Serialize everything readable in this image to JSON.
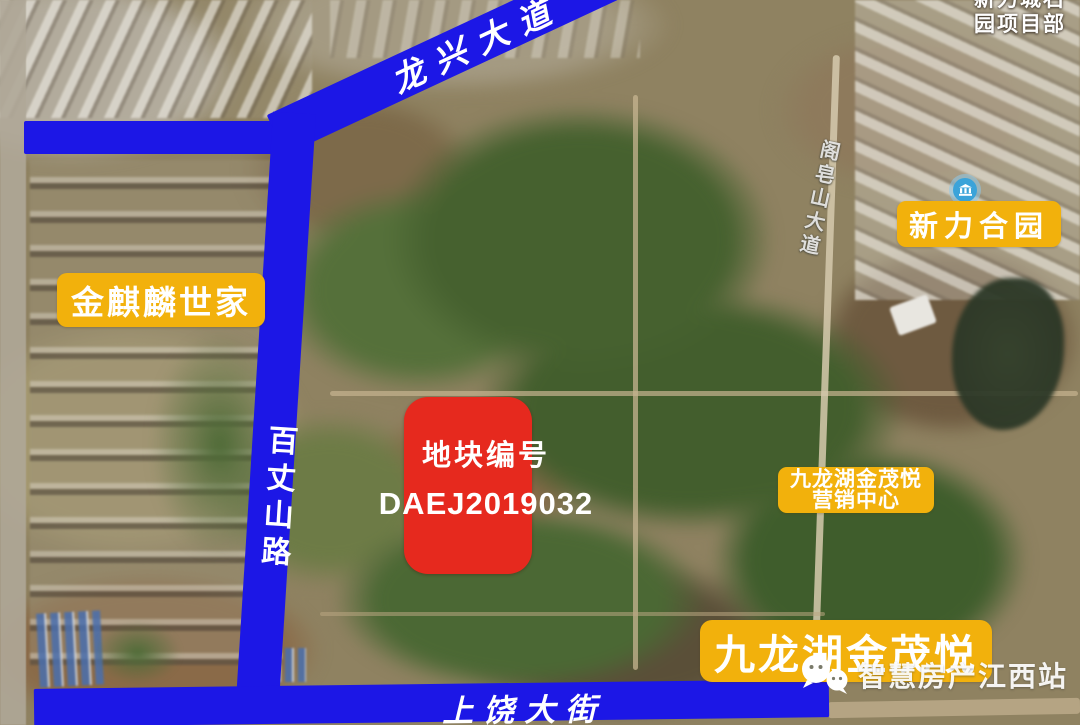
{
  "corner_overlay": {
    "line1": "新力城石",
    "line2": "园项目部"
  },
  "roads": {
    "longxing": "龙兴大道",
    "baizhangshan": "百丈山路",
    "shangrao": "上饶大街",
    "gezaoshan": "阁皂山大道"
  },
  "places": {
    "jinqilin": "金麒麟世家",
    "xinli_heyuan": "新力合园",
    "sales_center_line1": "九龙湖金茂悦",
    "sales_center_line2": "营销中心",
    "jinmao_main": "九龙湖金茂悦"
  },
  "parcel": {
    "label": "地块编号",
    "code": "DAEJ2019032"
  },
  "watermark": {
    "text": "智慧房产江西站",
    "logo_icon": "wechat-bubbles-icon"
  },
  "icons": {
    "poi": "building-poi-icon"
  },
  "colors": {
    "road_blue": "#1c17e6",
    "label_yellow": "#f2b10c",
    "parcel_red": "#e6291e",
    "poi_blue": "#3ba3d9",
    "text_white": "#ffffff"
  }
}
